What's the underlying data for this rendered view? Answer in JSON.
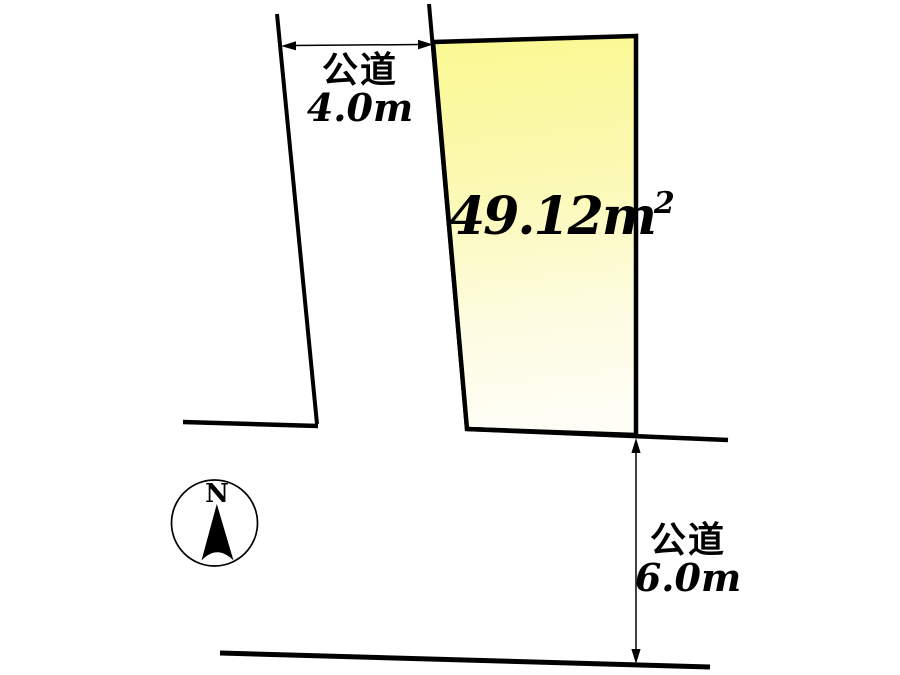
{
  "diagram": {
    "parcel": {
      "area_value": "49.12m",
      "area_sup": "2"
    },
    "road_left": {
      "name": "公道",
      "width": "4.0m"
    },
    "road_bottom": {
      "name": "公道",
      "width": "6.0m"
    },
    "compass": {
      "north": "N"
    },
    "colors": {
      "background": "#ffffff",
      "line": "#000000",
      "parcel_fill_top": "#fbf991",
      "parcel_fill_mid": "#fbf9b2",
      "parcel_fill_low": "#fdfcdf",
      "parcel_fill_bottom": "#fffef6"
    }
  }
}
